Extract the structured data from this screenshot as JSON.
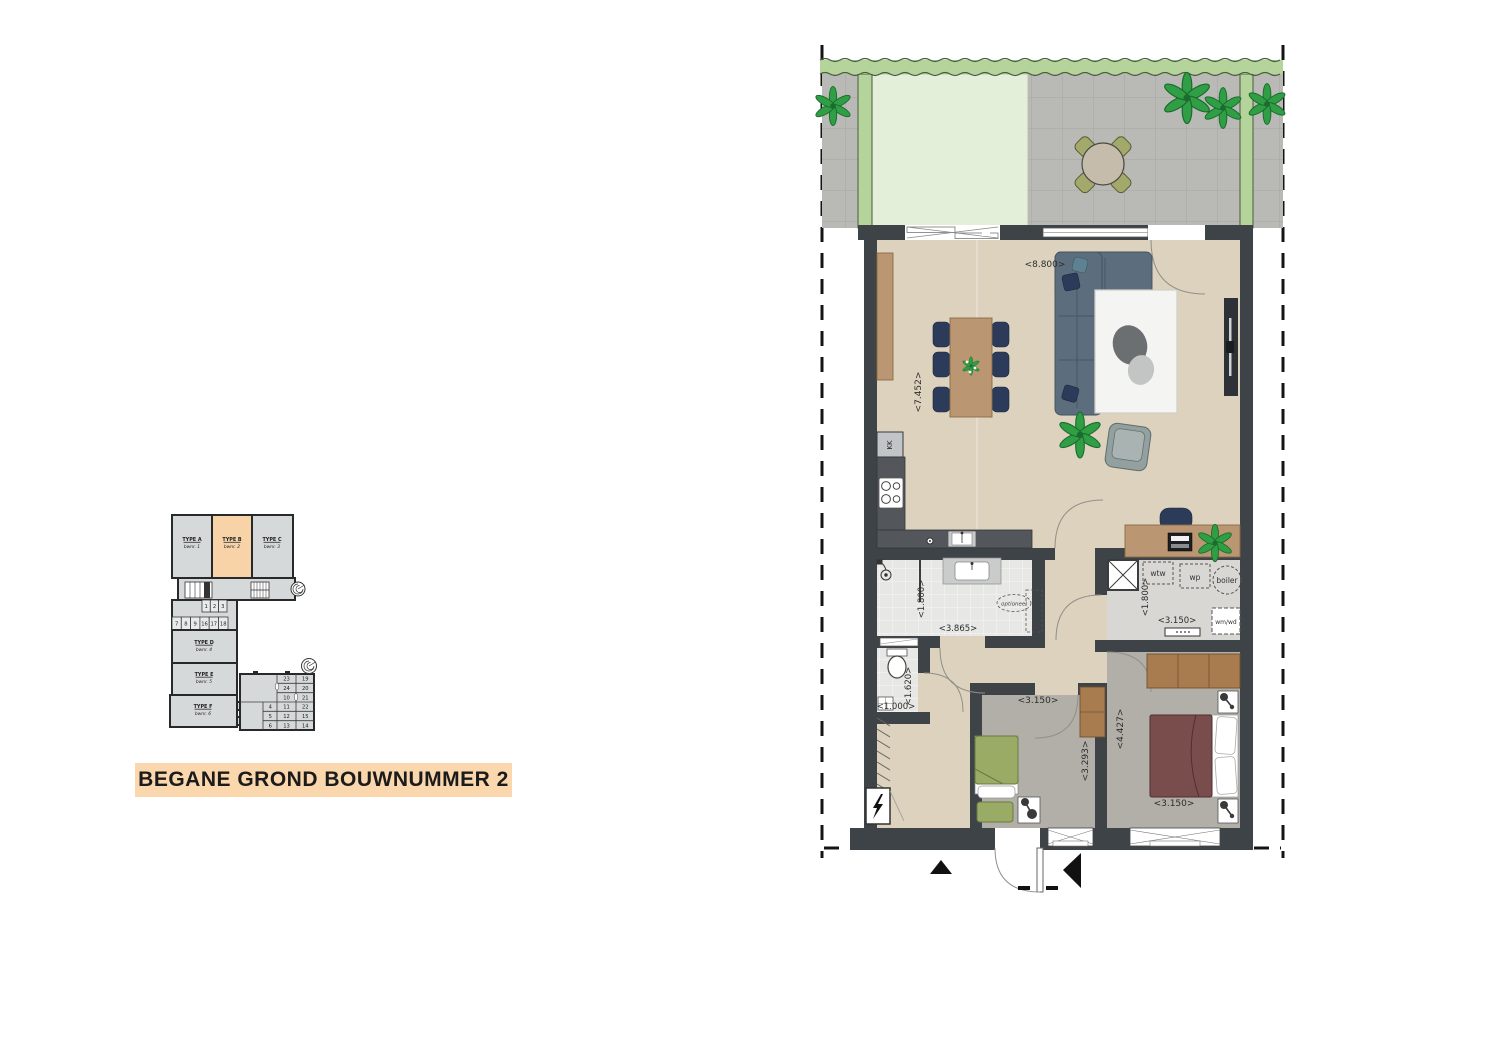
{
  "title": {
    "text": "BEGANE GROND BOUWNUMMER 2",
    "bg_color": "#fbd7ad"
  },
  "overview": {
    "units": [
      {
        "type": "TYPE A",
        "bwnr": "bwnr. 1",
        "highlighted": false
      },
      {
        "type": "TYPE B",
        "bwnr": "bwnr. 2",
        "highlighted": true
      },
      {
        "type": "TYPE C",
        "bwnr": "bwnr. 3",
        "highlighted": false
      },
      {
        "type": "TYPE D",
        "bwnr": "bwnr. 4",
        "highlighted": false
      },
      {
        "type": "TYPE E",
        "bwnr": "bwnr. 5",
        "highlighted": false
      },
      {
        "type": "TYPE F",
        "bwnr": "bwnr. 6",
        "highlighted": false
      }
    ],
    "cells_row1": [
      "1",
      "2",
      "3"
    ],
    "cells_row2": [
      "7",
      "8",
      "9",
      "16",
      "17",
      "18"
    ],
    "annex": {
      "col1": [
        "4",
        "5",
        "6"
      ],
      "col2": [
        "23",
        "24",
        "10",
        "11",
        "12",
        "13"
      ],
      "col3": [
        "19",
        "20",
        "21",
        "22",
        "15",
        "14"
      ]
    }
  },
  "plan": {
    "living_room": {
      "width_label": "<8.800>",
      "depth_label": "<7.452>"
    },
    "kitchen": {
      "fridge_label": "KK"
    },
    "bathroom": {
      "width_label": "<3.865>",
      "depth_label": "<1.800>",
      "optional_label": "optioneel"
    },
    "toilet": {
      "width_label": "<1.000>",
      "depth_label": "<1.620>"
    },
    "tech_room": {
      "width_label": "<3.150>",
      "depth_label": "<1.800>",
      "wtw_label": "wtw",
      "wp_label": "wp",
      "boiler_label": "boiler",
      "wm_wd_label": "wm/wd"
    },
    "bedroom1": {
      "width_label": "<3.150>",
      "depth_label": "<3.293>"
    },
    "bedroom2": {
      "width_label": "<3.150>",
      "depth_label": "<4.427>"
    },
    "colors": {
      "wall": "#3e4347",
      "floor_living": "#dcd2be",
      "floor_tile": "#e7e7e5",
      "floor_bedroom": "#b2aea8",
      "terrace_tile": "#b9bab6",
      "grass": "#e3efd9",
      "hedge": "#b5d49c",
      "wood": "#ba9772",
      "sofa": "#5c6d7d",
      "chair": "#2c3b5a",
      "bed_double": "#7a4d4d",
      "bed_single": "#9aab66",
      "wardrobe": "#a87c4f",
      "highlight": "#f8d3a8"
    }
  }
}
